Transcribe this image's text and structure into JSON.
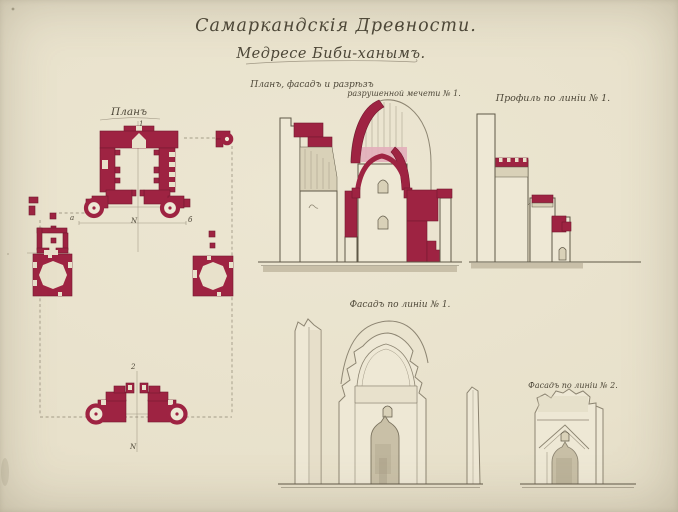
{
  "page": {
    "title": "Самаркандскія Древности.",
    "subtitle": "Медресе Биби-ханымъ."
  },
  "drawings": {
    "plan": {
      "label": "Планъ",
      "marks": [
        {
          "text": "1"
        },
        {
          "text": "N"
        },
        {
          "text": "а"
        },
        {
          "text": "б"
        },
        {
          "text": "2"
        },
        {
          "text": "N"
        }
      ]
    },
    "section": {
      "label_line1": "Планъ, фасадъ и разрѣзъ",
      "label_line2": "разрушенной мечети № 1."
    },
    "profile": {
      "label": "Профиль по линіи № 1."
    },
    "facade_main": {
      "label": "Фасадъ по линіи № 1."
    },
    "facade_small": {
      "label": "Фасадъ по линіи № 2."
    }
  },
  "palette": {
    "paper": "#e8e1cb",
    "paper_light": "#eee8d5",
    "crimson": "#9e2342",
    "crimson_dark": "#74182f",
    "pink": "#e3aeba",
    "ink": "#5f5847",
    "pencil": "#8d8572",
    "wash": "#c2b9a1",
    "shade": "#d9d1b8",
    "ink_text": "#4d4738"
  }
}
